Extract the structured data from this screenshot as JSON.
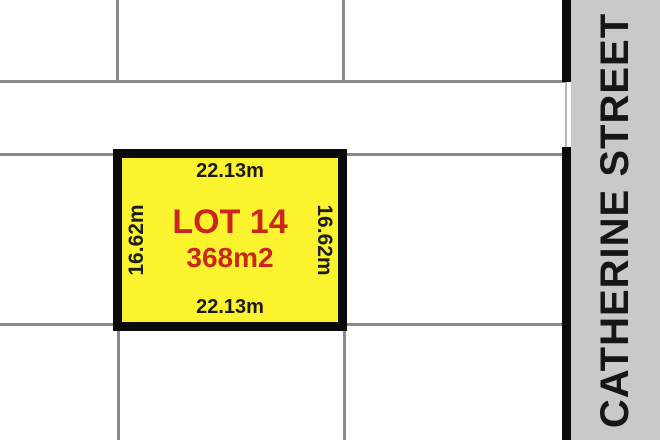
{
  "plan": {
    "street": {
      "name": "CATHERINE STREET"
    },
    "lot": {
      "name": "LOT 14",
      "area": "368m2",
      "frontage_top": "22.13m",
      "frontage_bottom": "22.13m",
      "depth_left": "16.62m",
      "depth_right": "16.62m"
    },
    "colors": {
      "lot_fill": "#FBF32D",
      "lot_text": "#C9261C",
      "dim_text": "#1C1C1C",
      "street_fill": "#C9C9C9",
      "street_text": "#161616",
      "boundary": "#8A8A8A",
      "border_black": "#0B0B0B"
    }
  }
}
